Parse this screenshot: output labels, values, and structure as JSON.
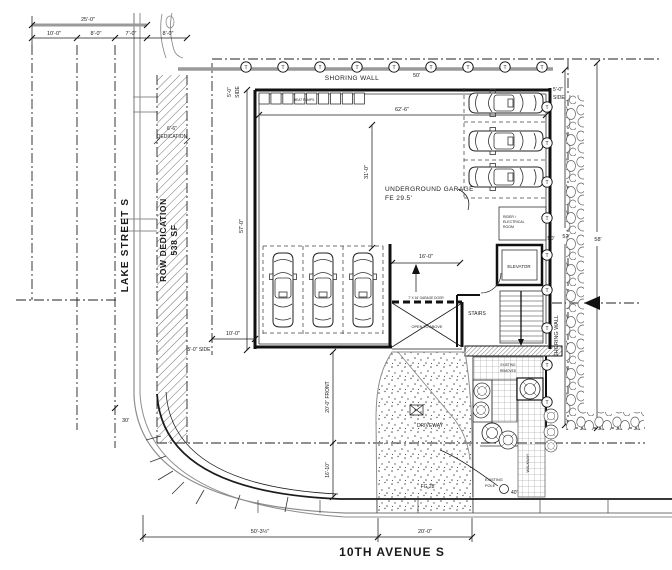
{
  "streets": {
    "west": "LAKE STREET S",
    "south": "10TH AVENUE S"
  },
  "row": {
    "label_1": "ROW DEDICATION",
    "label_2": "538 SF",
    "note_1": "6'-6\"",
    "note_2": "DEDICATION"
  },
  "shoring": {
    "top": "SHORING WALL",
    "top_len": "50'",
    "right": "SHORING WALL",
    "tieback": "T"
  },
  "garage": {
    "name_1": "UNDERGROUND GARAGE",
    "name_2": "FE 29.5'",
    "heat_pumps": "HEAT PUMPS",
    "door": "7' X 16' GARAGE DOOR",
    "open_above": "OPEN TO ABOVE"
  },
  "rooms": {
    "elevator": "ELEVATOR",
    "stairs": "STAIRS",
    "rider_1": "RIDER /",
    "rider_2": "ELECTRICAL",
    "rider_3": "ROOM"
  },
  "site": {
    "driveway": "DRIVEWAY",
    "grade": "FG 28'",
    "walkway": "WALKWAY",
    "pole_1": "EXISTING",
    "pole_2": "POLE",
    "pole_dim": "40'",
    "patio_1": "EXISTING",
    "patio_2": "REMOVED",
    "radius": "30'"
  },
  "dims": {
    "overall_top": "25'-0\"",
    "t1": "10'-0\"",
    "t2": "8'-0\"",
    "t3": "7'-0\"",
    "t4": "8'-0\"",
    "garage_w": "62'-6\"",
    "garage_d": "57'-0\"",
    "interior": "31'-0\"",
    "door_w": "16'-0\"",
    "west_gap": "10'-0\"",
    "front_1": "20'-0\" FRONT",
    "front_2": "16'-10\"",
    "south_1": "50'-3½\"",
    "south_2": "20'-0\"",
    "east_1": "50'",
    "east_2": "52'",
    "east_3": "58'",
    "side_nw_1": "5'-0\"",
    "side_nw_2": "SIDE",
    "side_sw": "5'-0\" SIDE",
    "side_ne_1": "5'-0\"",
    "side_ne_2": "SIDE"
  }
}
